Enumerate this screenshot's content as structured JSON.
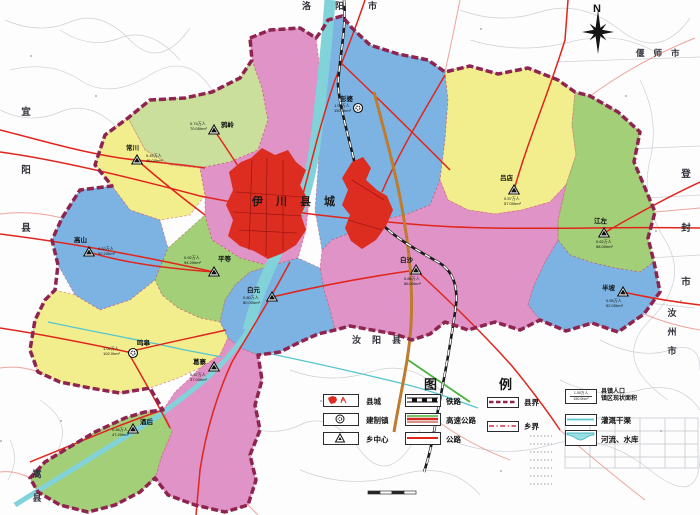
{
  "compass": {
    "label": "N"
  },
  "map": {
    "county_seat": "伊川县城",
    "neighbors": {
      "north": "洛阳市",
      "northeast": "偃师市",
      "east": "登封市",
      "southeast": "汝州市",
      "south": "汝阳县",
      "southwest": "嵩县",
      "west": "宜阳县"
    },
    "towns": [
      {
        "name": "彭婆",
        "marker": "circle-town",
        "stats1": "1.50万人",
        "stats2": "150.0hm²"
      },
      {
        "name": "鸦岭",
        "marker": "triangle-township",
        "stats1": "0.74万人",
        "stats2": "70.00hm²"
      },
      {
        "name": "常川",
        "marker": "triangle-township",
        "stats1": "0.45万人",
        "stats2": "45.00hm²"
      },
      {
        "name": "高山",
        "marker": "triangle-township",
        "stats1": "0.52万人",
        "stats2": "50.20hm²"
      },
      {
        "name": "平等",
        "marker": "triangle-township",
        "stats1": "0.92万人",
        "stats2": "94.20hm²"
      },
      {
        "name": "白元",
        "marker": "triangle-township",
        "stats1": "0.80万人",
        "stats2": "80.00hm²"
      },
      {
        "name": "白沙",
        "marker": "triangle-township",
        "stats1": "0.86万人",
        "stats2": "86.00hm²"
      },
      {
        "name": "吕店",
        "marker": "triangle-township",
        "stats1": "0.57万人",
        "stats2": "57.00hm²"
      },
      {
        "name": "江左",
        "marker": "triangle-township",
        "stats1": "0.62万人",
        "stats2": "58.00hm²"
      },
      {
        "name": "半坡",
        "marker": "triangle-township",
        "stats1": "0.55万人",
        "stats2": "52.00hm²"
      },
      {
        "name": "鸣皋",
        "marker": "circle-town",
        "stats1": "1.02万人",
        "stats2": "102.0hm²"
      },
      {
        "name": "葛寨",
        "marker": "triangle-township",
        "stats1": "0.37万人",
        "stats2": "37.00hm²"
      },
      {
        "name": "酒后",
        "marker": "triangle-township",
        "stats1": "0.46万人",
        "stats2": "47.20hm²"
      }
    ]
  },
  "legend": {
    "title": "图例",
    "points": [
      {
        "label": "县城"
      },
      {
        "label": "建制镇"
      },
      {
        "label": "乡中心"
      }
    ],
    "lines": [
      {
        "label": "铁路"
      },
      {
        "label": "高速公路"
      },
      {
        "label": "公路"
      }
    ],
    "boundaries": [
      {
        "label": "县界"
      },
      {
        "label": "乡界"
      }
    ],
    "misc": [
      {
        "label": "县镇人口",
        "label2": "镇区现状面积",
        "sample_top": "1.50万人",
        "sample_bottom": "150.0hm²"
      },
      {
        "label": "灌溉干渠"
      },
      {
        "label": "河流、水库"
      }
    ]
  },
  "colors": {
    "region_pink": "#df93c6",
    "region_yellow": "#f2ee8e",
    "region_blue": "#7db3e2",
    "region_green": "#a2cf78",
    "region_light_green": "#c9df9b",
    "urban_red": "#dd2c20",
    "county_boundary": "#8e2450",
    "road_red": "#e0251c",
    "expressway_orange": "#bf7b2e",
    "water_cyan": "#82d2da",
    "railway_black": "#1a1a1a"
  }
}
